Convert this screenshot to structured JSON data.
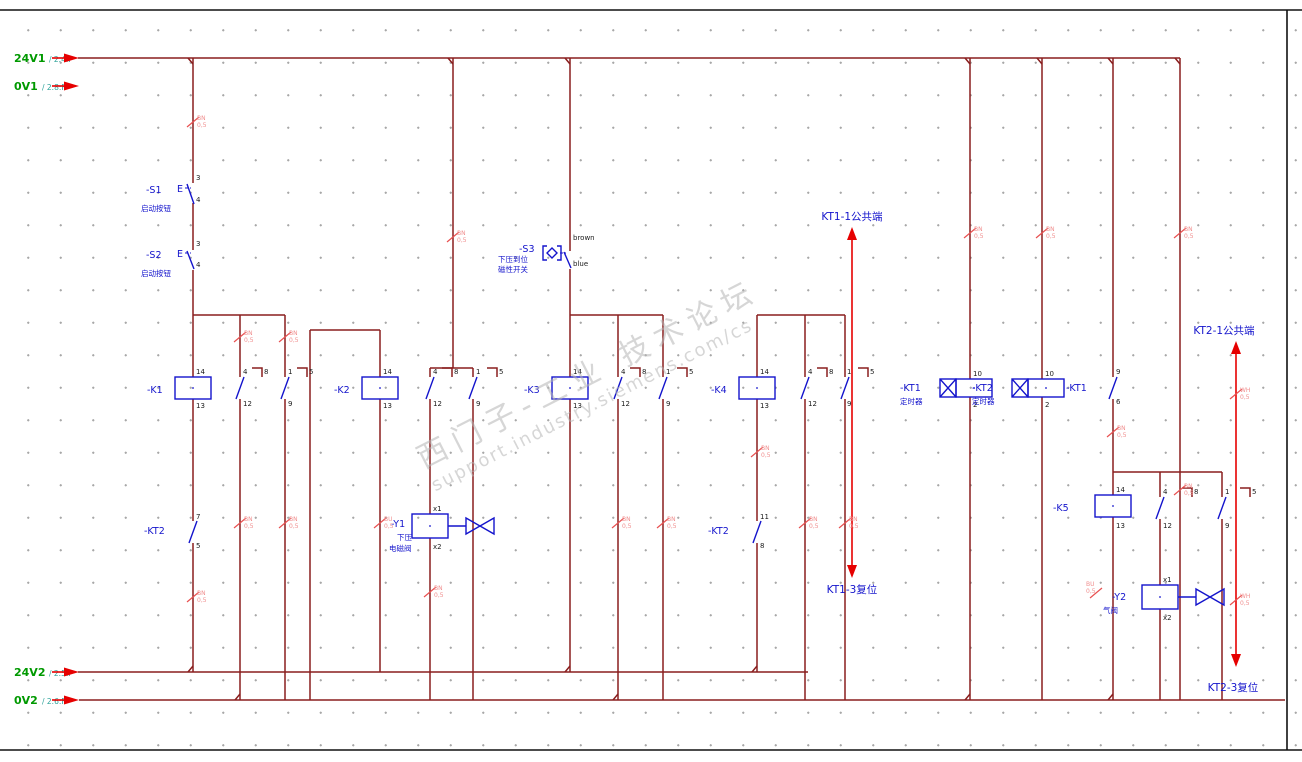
{
  "rails": {
    "v24_1": {
      "label": "24V1",
      "ref": "/ 2.4:F"
    },
    "v0_1": {
      "label": "0V1",
      "ref": "/ 2.8:F"
    },
    "v24_2": {
      "label": "24V2",
      "ref": "/ 2.5:F"
    },
    "v0_2": {
      "label": "0V2",
      "ref": "/ 2.6:F"
    }
  },
  "switches": {
    "s1": {
      "tag": "-S1",
      "op": "E",
      "desc": "启动按钮",
      "pt": "3",
      "pb": "4"
    },
    "s2": {
      "tag": "-S2",
      "op": "E",
      "desc": "启动按钮",
      "pt": "3",
      "pb": "4"
    },
    "s3": {
      "tag": "-S3",
      "desc1": "下压到位",
      "desc2": "磁性开关",
      "wt": "brown",
      "wb": "blue"
    }
  },
  "relays": {
    "k1": {
      "tag": "-K1",
      "p14": "14",
      "p13": "13",
      "c1t": "4",
      "c1b": "12",
      "c1x": "8",
      "c2t": "1",
      "c2b": "9",
      "c2x": "5"
    },
    "k2": {
      "tag": "-K2",
      "p14": "14",
      "p13": "13",
      "c1t": "4",
      "c1b": "12",
      "c1x": "8",
      "c2t": "1",
      "c2b": "9",
      "c2x": "5"
    },
    "k3": {
      "tag": "-K3",
      "p14": "14",
      "p13": "13",
      "c1t": "4",
      "c1b": "12",
      "c1x": "8",
      "c2t": "1",
      "c2b": "9",
      "c2x": "5"
    },
    "k4": {
      "tag": "-K4",
      "p14": "14",
      "p13": "13",
      "c1t": "4",
      "c1b": "12",
      "c1x": "8",
      "c2t": "1",
      "c2b": "9",
      "c2x": "5"
    },
    "k5": {
      "tag": "-K5",
      "p14": "14",
      "p13": "13",
      "c1t": "4",
      "c1b": "12",
      "c1x": "8",
      "c2t": "1",
      "c2b": "9",
      "c2x": "5"
    }
  },
  "timers": {
    "kt1": {
      "tag": "-KT1",
      "desc": "定时器",
      "pt": "10",
      "pb": "2"
    },
    "kt2": {
      "tag": "-KT2",
      "desc": "定时器",
      "pt": "10",
      "pb": "2"
    },
    "kt1_contact": {
      "tag": "-KT1",
      "pt": "9",
      "pb": "6"
    },
    "kt2_contact_left": {
      "tag": "-KT2",
      "pt": "7",
      "pb": "5"
    },
    "kt2_contact_mid": {
      "tag": "-KT2",
      "pt": "11",
      "pb": "8"
    }
  },
  "valves": {
    "y1": {
      "tag": "-Y1",
      "desc1": "下压",
      "desc2": "电磁阀",
      "pt": "x1",
      "pb": "x2"
    },
    "y2": {
      "tag": "-Y2",
      "desc": "气阀",
      "pt": "x1",
      "pb": "x2"
    }
  },
  "annotations": {
    "kt1_common": "KT1-1公共端",
    "kt1_reset": "KT1-3复位",
    "kt2_common": "KT2-1公共端",
    "kt2_reset": "KT2-3复位"
  },
  "wire_tags": [
    {
      "l1": "BN",
      "l2": "0,5"
    },
    {
      "l1": "BN",
      "l2": "0,5"
    },
    {
      "l1": "BN",
      "l2": "0,5"
    },
    {
      "l1": "BN",
      "l2": "0,5"
    },
    {
      "l1": "BN",
      "l2": "0,5"
    },
    {
      "l1": "BU",
      "l2": "0,5"
    },
    {
      "l1": "BN",
      "l2": "0,5"
    },
    {
      "l1": "BN",
      "l2": "0,5"
    },
    {
      "l1": "BN",
      "l2": "0,5"
    },
    {
      "l1": "BN",
      "l2": "0,5"
    },
    {
      "l1": "BN",
      "l2": "0,5"
    },
    {
      "l1": "BN",
      "l2": "0,5"
    },
    {
      "l1": "BN",
      "l2": "0,5"
    },
    {
      "l1": "BN",
      "l2": "0,5"
    },
    {
      "l1": "BN",
      "l2": "0,5"
    },
    {
      "l1": "BN",
      "l2": "0,5"
    },
    {
      "l1": "BN",
      "l2": "0,5"
    },
    {
      "l1": "BN",
      "l2": "0,5"
    },
    {
      "l1": "WH",
      "l2": "0,5"
    },
    {
      "l1": "WH",
      "l2": "0,5"
    },
    {
      "l1": "BU",
      "l2": "0,5"
    },
    {
      "l1": "BN",
      "l2": "0,5"
    }
  ],
  "watermark": {
    "line1": "西门子-工业 技术论坛",
    "line2": "support.industry.siemens.com/cs"
  }
}
